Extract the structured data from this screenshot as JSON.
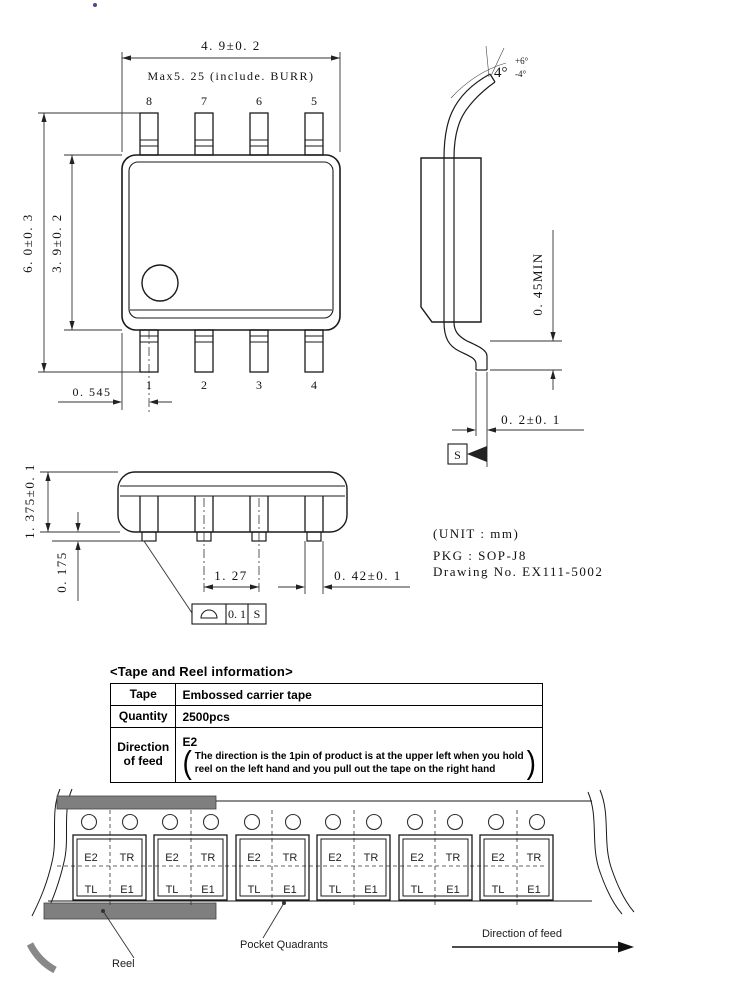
{
  "drawing": {
    "dims": {
      "width": "4. 9±0. 2",
      "width_max": "Max5. 25 (include. BURR)",
      "total_height": "6. 0±0. 3",
      "body_height": "3. 9±0. 2",
      "pin1_offset": "0. 545",
      "angle_base": "4°",
      "angle_plus": "+6°",
      "angle_minus": "-4°",
      "foot_min": "0. 45MIN",
      "lead_thickness": "0. 2±0. 1",
      "datum_s": "S",
      "pkg_height": "1. 375±0. 1",
      "standoff": "0. 175",
      "pitch": "1. 27",
      "lead_width": "0. 42±0. 1",
      "fcf_value": "0. 1",
      "fcf_datum": "S"
    },
    "pins": {
      "top": [
        "8",
        "7",
        "6",
        "5"
      ],
      "bottom": [
        "1",
        "2",
        "3",
        "4"
      ]
    },
    "notes": {
      "unit": "(UNIT : mm)",
      "pkg": "PKG : SOP-J8",
      "drawing_no": "Drawing No. EX111-5002"
    }
  },
  "tape_reel": {
    "title": "<Tape and Reel information>",
    "table": {
      "tape_label": "Tape",
      "tape_value": "Embossed carrier tape",
      "quantity_label": "Quantity",
      "quantity_value": "2500pcs",
      "direction_label": "Direction of feed",
      "direction_value": "E2",
      "note_line1": "The direction is the 1pin of product is at the upper left when you hold",
      "note_line2": "reel on the left hand and you pull out the tape on the right hand",
      "paren_open": "(",
      "paren_close": ")"
    },
    "quadrants": {
      "e2": "E2",
      "tr": "TR",
      "tl": "TL",
      "e1": "E1"
    },
    "labels": {
      "reel": "Reel",
      "pocket_quadrants": "Pocket Quadrants",
      "direction_of_feed": "Direction of feed"
    }
  }
}
